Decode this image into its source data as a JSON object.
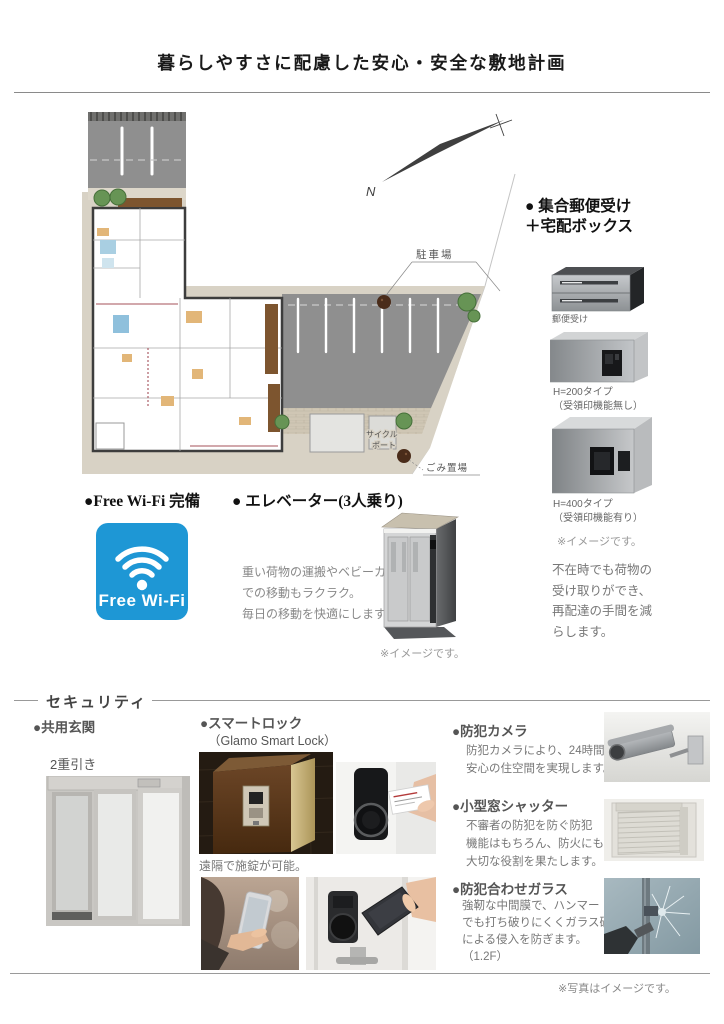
{
  "page": {
    "title": "暮らしやすさに配慮した安心・安全な敷地計画",
    "photo_note": "※写真はイメージです。"
  },
  "site_plan": {
    "parking_label": "駐車場",
    "cycle_port_label": [
      "サイクル",
      "ポート"
    ],
    "garbage_label": "ごみ置場",
    "north_label": "N"
  },
  "mailbox": {
    "heading": [
      "● 集合郵便受け",
      "＋宅配ボックス"
    ],
    "mail_label": "郵便受け",
    "type200": [
      "H=200タイプ",
      "（受領印機能無し）"
    ],
    "type400": [
      "H=400タイプ",
      "（受領印機能有り）"
    ],
    "image_note": "※イメージです。",
    "description": [
      "不在時でも荷物の",
      "受け取りができ、",
      "再配達の手間を減",
      "らします。"
    ]
  },
  "wifi": {
    "heading": "●Free Wi-Fi 完備",
    "logo_text": "Free Wi-Fi",
    "logo_color": "#1e97d5"
  },
  "elevator": {
    "heading": "● エレベーター(3人乗り)",
    "description": [
      "重い荷物の運搬やベビーカー",
      "での移動もラクラク。",
      "毎日の移動を快適にします。"
    ],
    "image_note": "※イメージです。"
  },
  "security": {
    "section_title": "セキュリティ",
    "entrance": {
      "heading": "●共用玄関",
      "type_label": "2重引き"
    },
    "smart_lock": {
      "heading": "●スマートロック",
      "subheading": "（Glamo Smart Lock）",
      "caption": "遠隔で施錠が可能。"
    },
    "camera": {
      "heading": "●防犯カメラ",
      "description": [
        "防犯カメラにより、24時間",
        "安心の住空間を実現します。"
      ]
    },
    "shutter": {
      "heading": "●小型窓シャッター",
      "description": [
        "不審者の防犯を防ぐ防犯",
        "機能はもちろん、防火にも",
        "大切な役割を果たします。"
      ]
    },
    "glass": {
      "heading": "●防犯合わせガラス",
      "description": [
        "強靭な中間膜で、ハンマー",
        "でも打ち破りにくくガラス破り",
        "による侵入を防ぎます。",
        "（1.2F）"
      ]
    }
  }
}
